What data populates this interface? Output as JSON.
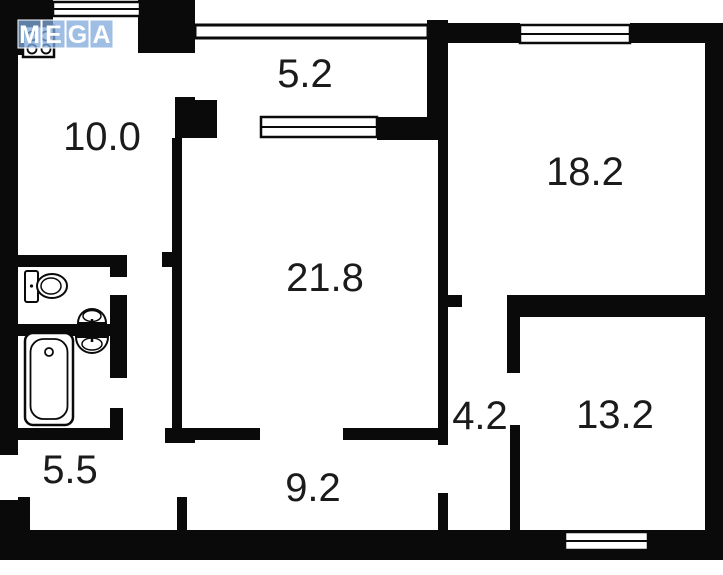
{
  "title": "apartment-floor-plan",
  "colors": {
    "wall": "#0a0a0a",
    "label": "#1b1b1b",
    "watermark_box": "#7fa8d9",
    "watermark_text": "#ffffff",
    "background": "#ffffff"
  },
  "watermark": {
    "letters": [
      "M",
      "E",
      "G",
      "A"
    ]
  },
  "rooms": {
    "kitchen": {
      "area": "10.0"
    },
    "balcony": {
      "area": "5.2"
    },
    "living_room": {
      "area": "21.8"
    },
    "bedroom_top_right": {
      "area": "18.2"
    },
    "inner_hall": {
      "area": "4.2"
    },
    "bedroom_bottom_right": {
      "area": "13.2"
    },
    "entry_hall": {
      "area": "5.5"
    },
    "corridor": {
      "area": "9.2"
    }
  },
  "fixtures": [
    "stove-burners",
    "toilet",
    "wash-basin-wc",
    "wash-basin-bath",
    "bathtub"
  ],
  "window_count": 4
}
